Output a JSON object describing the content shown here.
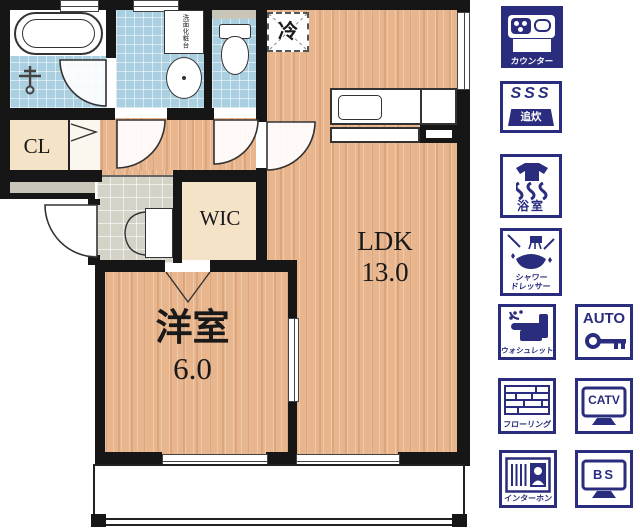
{
  "title": "1LDK floor plan with amenity legend",
  "floorplan": {
    "rooms": {
      "ldk": {
        "name": "LDK",
        "size": "13.0"
      },
      "bedroom": {
        "name": "洋室",
        "size": "6.0"
      },
      "wic": {
        "name": "WIC"
      },
      "closet": {
        "name": "CL"
      },
      "fridge": {
        "name": "冷"
      },
      "vanity": {
        "name": "洗面化粧台"
      }
    }
  },
  "legend": {
    "counter": {
      "label": "カウンター"
    },
    "oidaki": {
      "label": "追炊",
      "steam": "SSS"
    },
    "bath_dryer": {
      "label": "浴室"
    },
    "shower_dresser": {
      "line1": "シャワー",
      "line2": "ドレッサー"
    },
    "washlet": {
      "label": "ウォシュレット"
    },
    "autolock": {
      "label": "AUTO"
    },
    "flooring": {
      "label": "フローリング"
    },
    "catv": {
      "label": "CATV"
    },
    "interphone": {
      "label": "インターホン"
    },
    "bs": {
      "label": "BS"
    }
  },
  "colors": {
    "icon_navy": "#2a2d7d",
    "wall_black": "#161616",
    "wood_floor": "#e8b58c",
    "tile_blue": "#a9cfe0",
    "room_beige": "#f5e3c8",
    "genkan_gray": "#d5d2c8"
  }
}
